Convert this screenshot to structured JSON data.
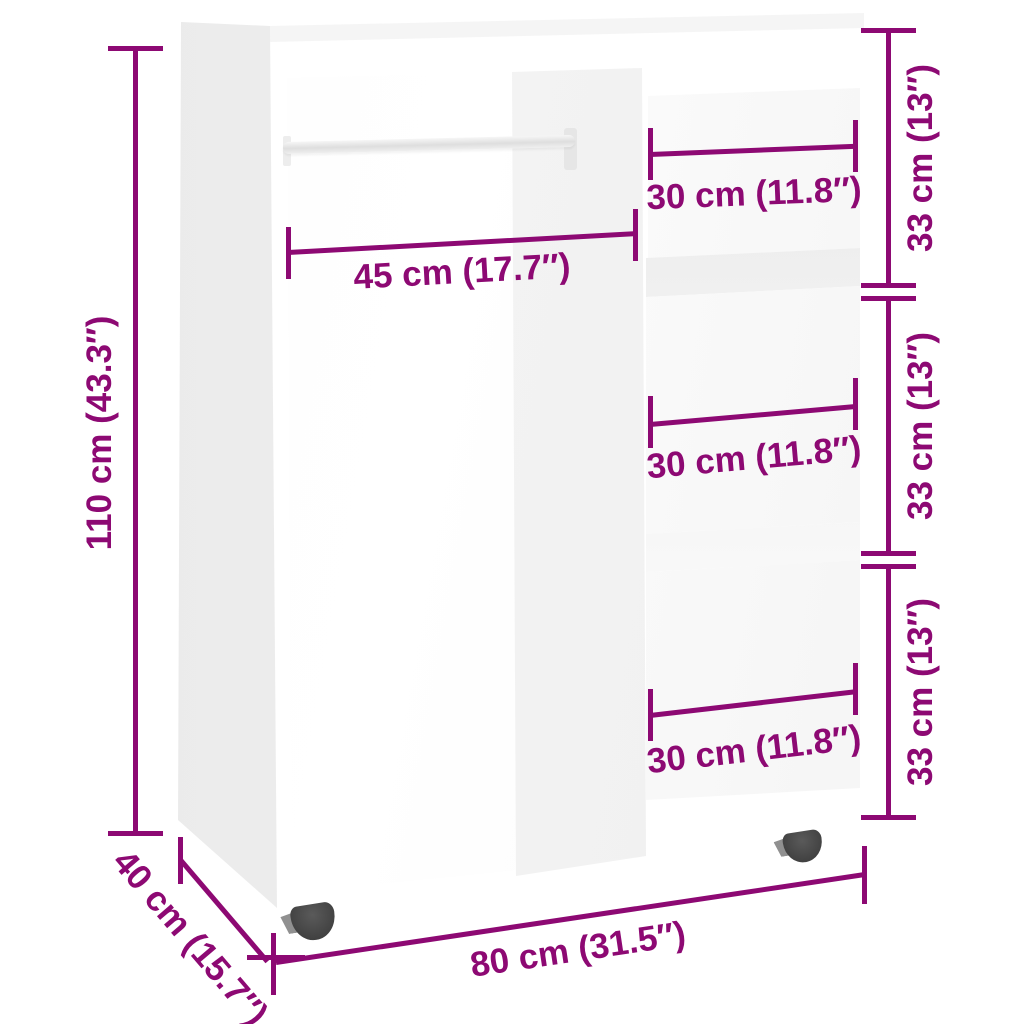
{
  "page": {
    "background_color": "#ffffff",
    "accent_color": "#8d0973",
    "product": "open wardrobe with clothes rail, three shelf compartments and wheels"
  },
  "annotations": {
    "height": "110 cm (43.3″)",
    "rod_width": "45 cm (17.7″)",
    "top_compartment_width": "30 cm (11.8″)",
    "middle_compartment_width": "30 cm (11.8″)",
    "bottom_compartment_width": "30 cm (11.8″)",
    "top_compartment_height": "33 cm (13″)",
    "middle_compartment_height": "33 cm (13″)",
    "bottom_compartment_height": "33 cm (13″)",
    "width": "80 cm (31.5″)",
    "depth": "40 cm (15.7″)"
  }
}
